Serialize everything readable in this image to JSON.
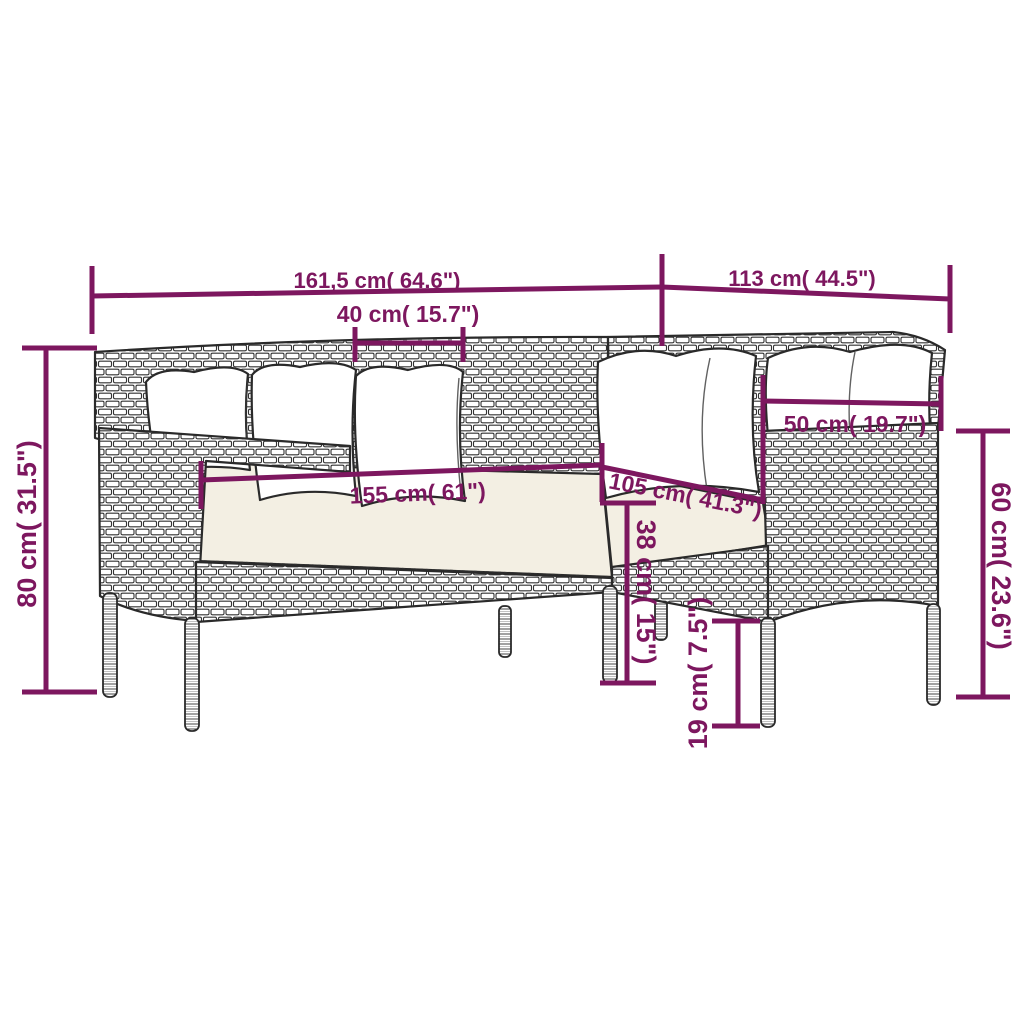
{
  "title": "L-shaped rattan corner sofa dimension diagram",
  "colors": {
    "dimension_accent": "#7d175f",
    "line_art": "#2a2a2a",
    "seat_cushion": "#f3efe3",
    "pillow": "#ffffff",
    "background": "#ffffff"
  },
  "dimensions": {
    "total_width": "161,5 cm( 64.6\")",
    "total_depth": "113 cm( 44.5\")",
    "back_pillow_width": "40 cm( 15.7\")",
    "side_pillow_width": "50 cm( 19.7\")",
    "seat_length": "155 cm( 61\")",
    "seat_side_length": "105 cm( 41.3\")",
    "total_height": "80 cm( 31.5\")",
    "back_height": "60 cm( 23.6\")",
    "seat_height": "38 cm( 15\")",
    "ground_clearance": "19 cm( 7.5\")"
  }
}
